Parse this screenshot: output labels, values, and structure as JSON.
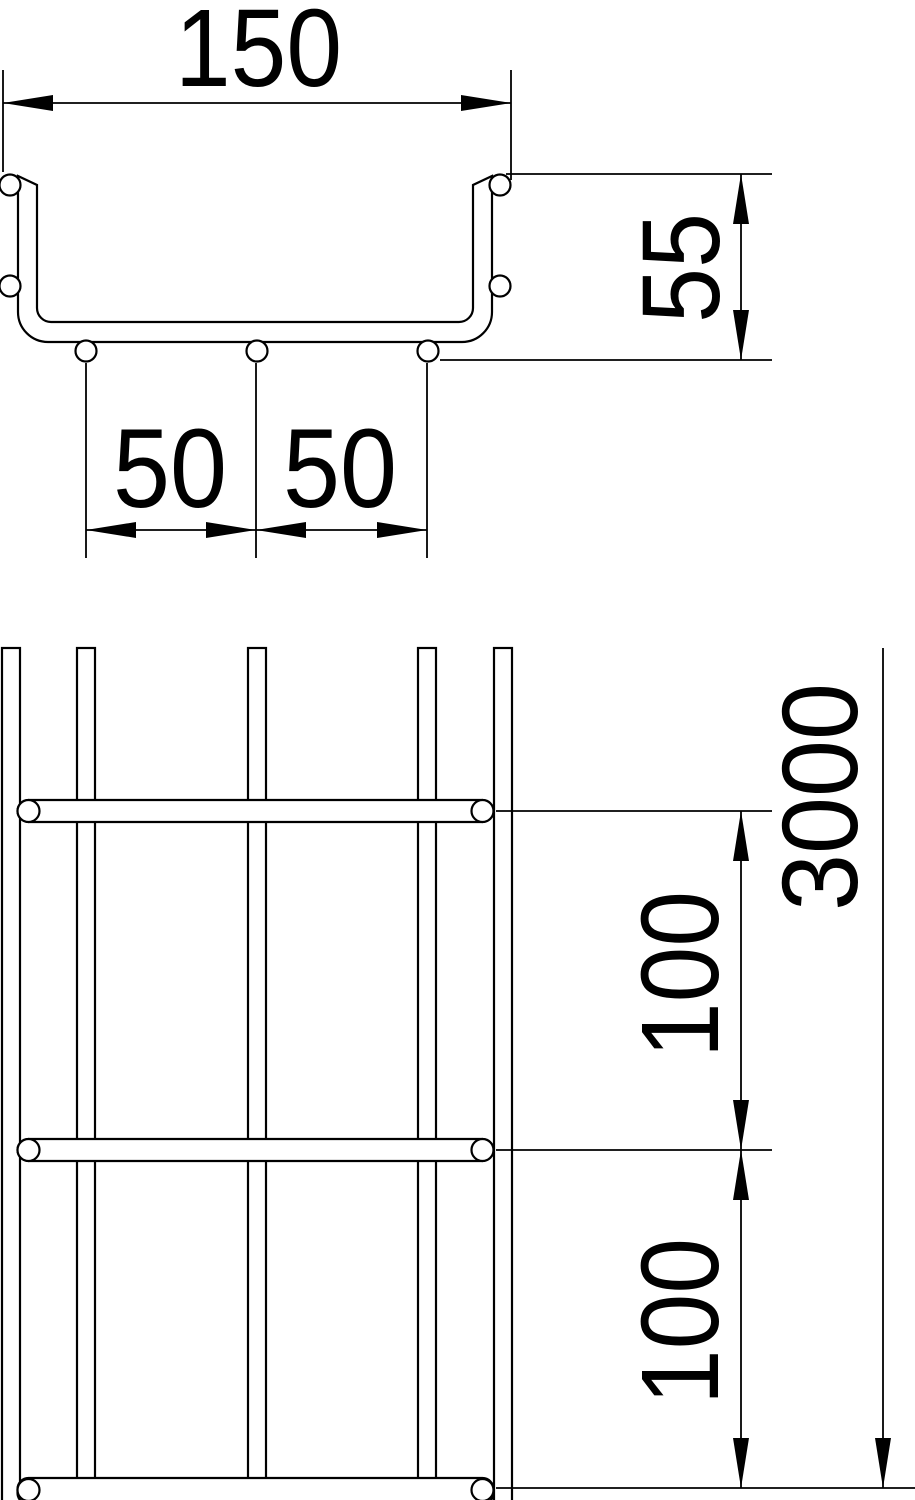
{
  "drawing": {
    "type": "technical-dimension-drawing",
    "subject": "wire-mesh cable tray (cross-section and plan view)",
    "background_color": "#ffffff",
    "line_color": "#000000",
    "labels": {
      "tray_width_mm": "150",
      "tray_height_mm": "55",
      "bottom_wire_spacing_left_mm": "50",
      "bottom_wire_spacing_right_mm": "50",
      "tray_length_mm": "3000",
      "rung_pitch_upper_mm": "100",
      "rung_pitch_lower_mm": "100"
    }
  }
}
